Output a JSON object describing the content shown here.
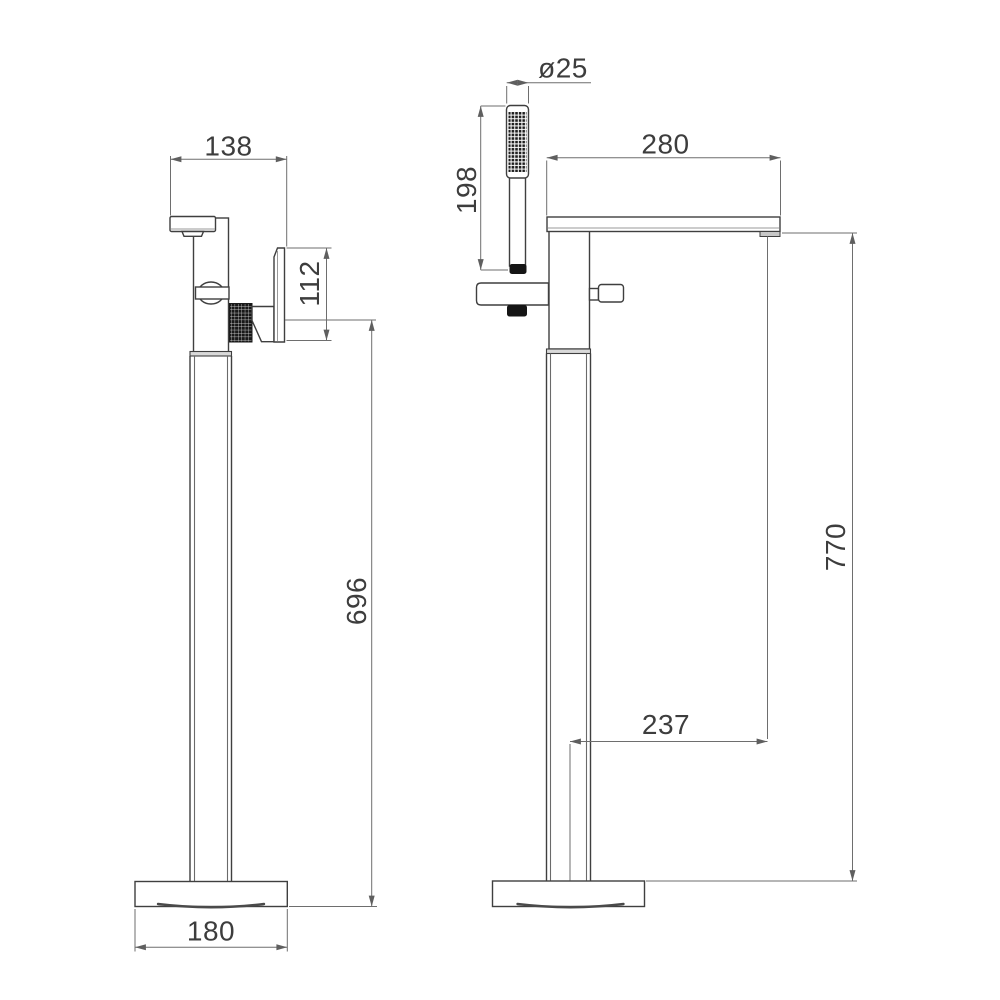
{
  "meta": {
    "title": "Freestanding bath shower mixer - dimensional technical drawing",
    "units": "mm",
    "background": "#ffffff"
  },
  "colors": {
    "outline": "#3f3f3f",
    "dimension_line": "#6e6e6e",
    "text": "#3d3d3d",
    "dark_fill": "#181818",
    "collar_fill": "#d9d9d9"
  },
  "views": {
    "front": {
      "name": "front view",
      "dims": {
        "spout_reach": {
          "label": "138"
        },
        "bracket_height": {
          "label": "112"
        },
        "outlet_height": {
          "label": "696"
        },
        "base_width": {
          "label": "180"
        }
      }
    },
    "side": {
      "name": "side view",
      "dims": {
        "handset_diameter": {
          "label": "ø25"
        },
        "handset_length": {
          "label": "198"
        },
        "spout_projection": {
          "label": "280"
        },
        "overall_height": {
          "label": "770"
        },
        "spout_reach_from_axis": {
          "label": "237"
        }
      }
    }
  }
}
